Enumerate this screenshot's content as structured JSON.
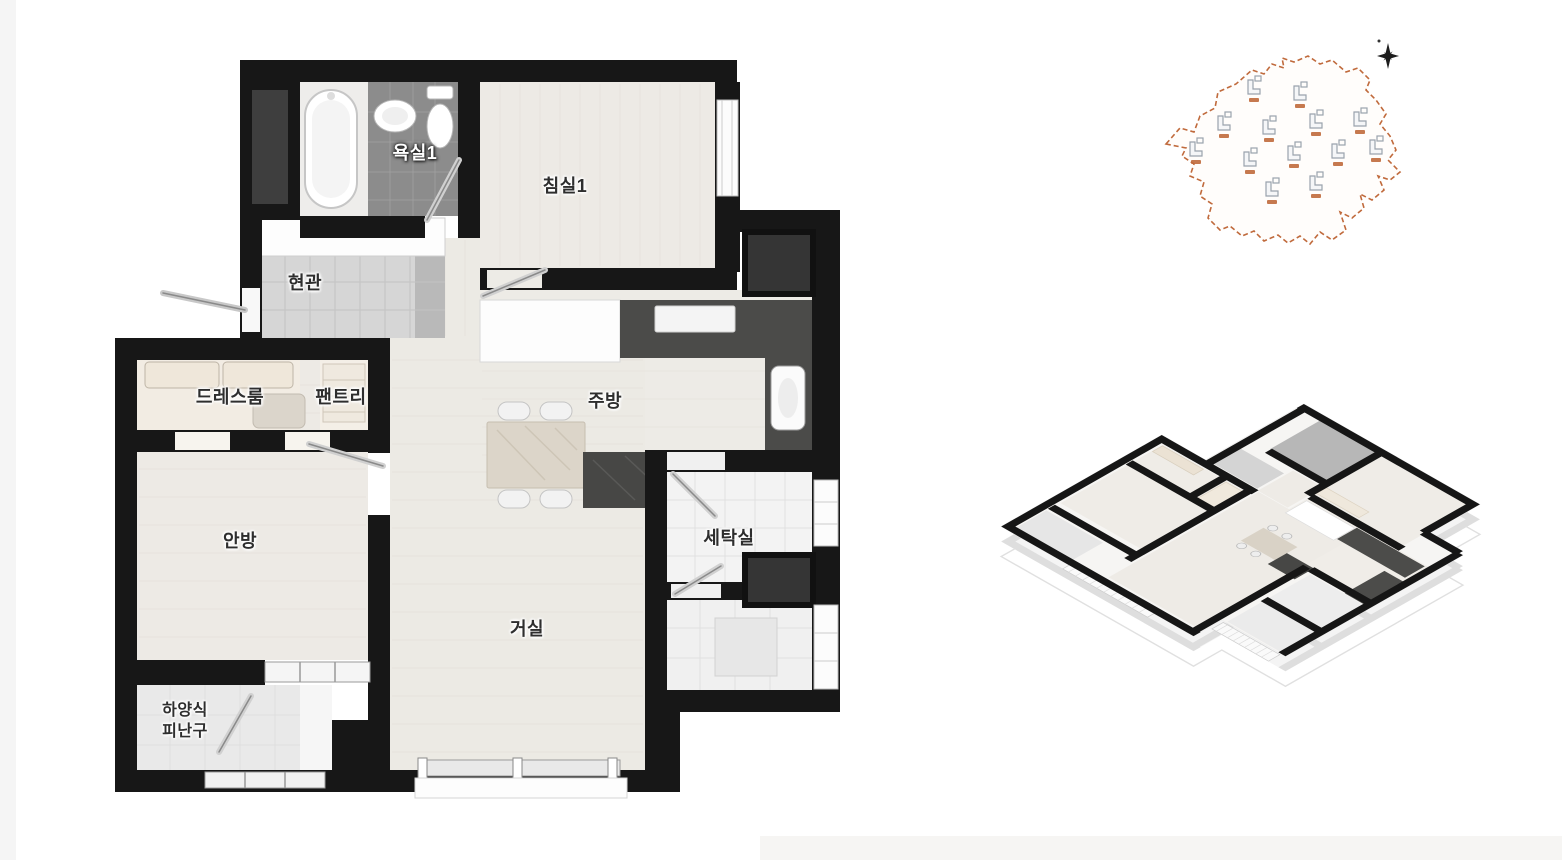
{
  "page": {
    "background": "#ffffff",
    "description": "Korean apartment unit floor plan sheet with 2D plan, site map and isometric 3D plan"
  },
  "plan2d": {
    "rooms": {
      "bathroom1": "욕실1",
      "bedroom1": "침실1",
      "entrance": "현관",
      "dressroom": "드레스룸",
      "pantry": "팬트리",
      "kitchen": "주방",
      "laundry": "세탁실",
      "master_bedroom": "안방",
      "living_room": "거실",
      "evac_line1": "하양식",
      "evac_line2": "피난구"
    },
    "colors": {
      "wall": "#171717",
      "wood_floor": "#edeae5",
      "bath_tile": "#8c8c8c",
      "entrance_tile": "#d6d6d6",
      "counter_dark": "#4b4b49",
      "table_marble": "#dcd5c9"
    }
  },
  "site_map": {
    "building_count": 13,
    "boundary_color": "#c06a3c",
    "building_color": "#9aa3ad",
    "compass": "north"
  },
  "iso_view": {
    "wall_color": "#161616",
    "floor_color": "#f6f5f3"
  }
}
